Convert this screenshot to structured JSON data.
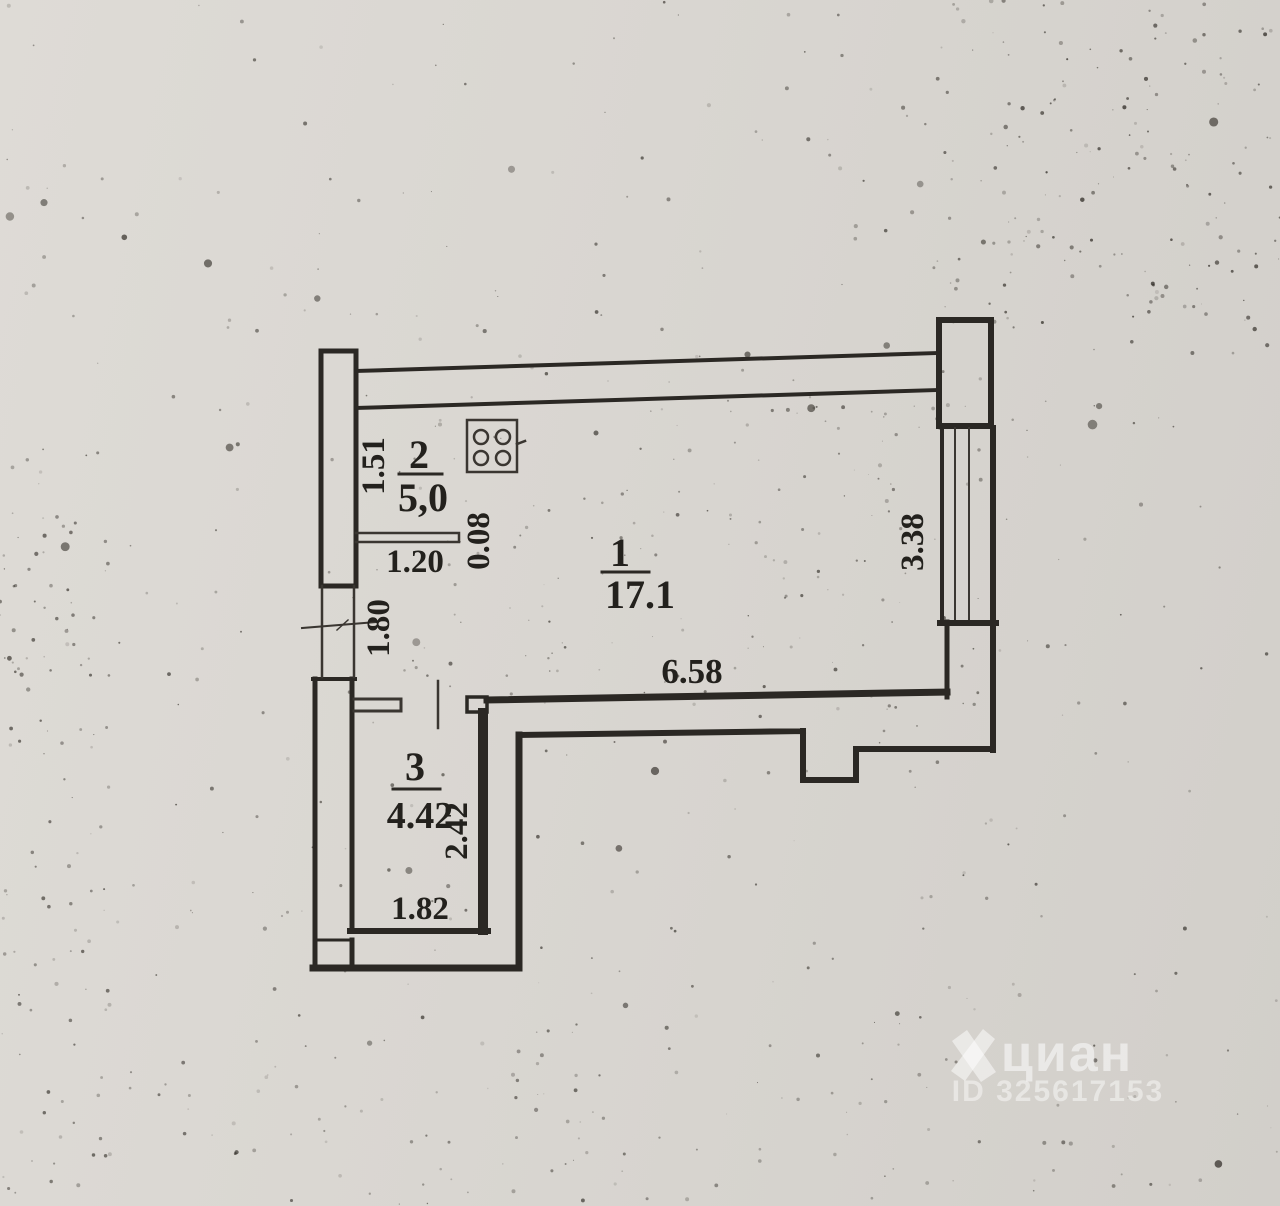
{
  "colors": {
    "paper": "#d9d6d1",
    "ink": "#23211d",
    "wall": "#2b2824",
    "watermark": "rgba(255,255,255,0.52)"
  },
  "plan": {
    "rooms": [
      {
        "number": "1",
        "area": "17.1"
      },
      {
        "number": "2",
        "area": "5,0"
      },
      {
        "number": "3",
        "area": "4.42"
      }
    ],
    "dimensions": {
      "kitchen_depth": "1.51",
      "partition_length": "1.20",
      "partition_thickness": "0.08",
      "entry_opening": "1.80",
      "room1_width": "6.58",
      "window_length": "3.38",
      "room3_depth": "2.42",
      "room3_width": "1.82"
    },
    "icons": {
      "stove": "stove-icon"
    }
  },
  "watermark": {
    "brand": "циан",
    "listing_id": "ID 325617153"
  }
}
